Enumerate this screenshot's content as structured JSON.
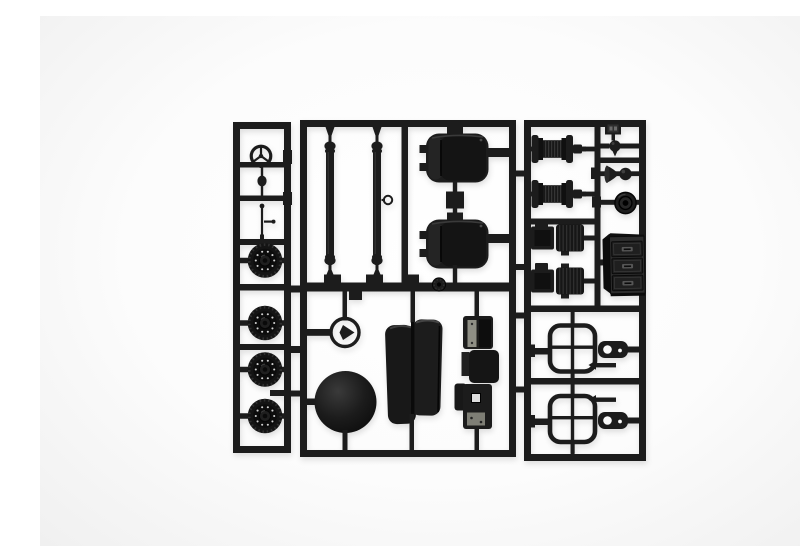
{
  "meta": {
    "description": "Photograph of a black plastic scale-model sprue (parts tree) holding molded truck-model parts, lying on a plain white studio background",
    "plastic_finish": "matte black styrene",
    "background_style": "plain white, soft shadow under sprue"
  },
  "colors": {
    "background": "#fcfcfc",
    "plastic": "#1c1c1c",
    "plastic-dark": "#0d0d0d",
    "plastic-mid": "#262626",
    "highlight": "#3e3e3e",
    "silver": "#8f8f85",
    "paper-white": "#fafafa"
  },
  "sections": {
    "left_runner": {
      "parts": [
        {
          "name": "steering wheel",
          "qty": 1
        },
        {
          "name": "gear shift knob",
          "qty": 1
        },
        {
          "name": "control lever",
          "qty": 1
        },
        {
          "name": "road wheel",
          "qty": 4
        }
      ]
    },
    "middle_runner": {
      "parts": [
        {
          "name": "drive shaft rod",
          "qty": 2
        },
        {
          "name": "tow ring",
          "qty": 1
        },
        {
          "name": "seat cushion",
          "qty": 2
        },
        {
          "name": "small pulley",
          "qty": 1
        },
        {
          "name": "fan ring",
          "qty": 1
        },
        {
          "name": "spare tire",
          "qty": 1
        },
        {
          "name": "folded tarpaulin",
          "qty": 1
        },
        {
          "name": "engine block",
          "qty": 1
        }
      ]
    },
    "right_runner": {
      "parts": [
        {
          "name": "sprue number tag",
          "qty": 1
        },
        {
          "name": "valve knob",
          "qty": 1
        },
        {
          "name": "air horn",
          "qty": 1
        },
        {
          "name": "pulley drum",
          "qty": 1
        },
        {
          "name": "cable spool",
          "qty": 2
        },
        {
          "name": "winch assembly",
          "qty": 2
        },
        {
          "name": "three-drawer cabinet",
          "qty": 1
        },
        {
          "name": "window frame",
          "qty": 2
        },
        {
          "name": "mounting plate",
          "qty": 2
        }
      ]
    }
  }
}
